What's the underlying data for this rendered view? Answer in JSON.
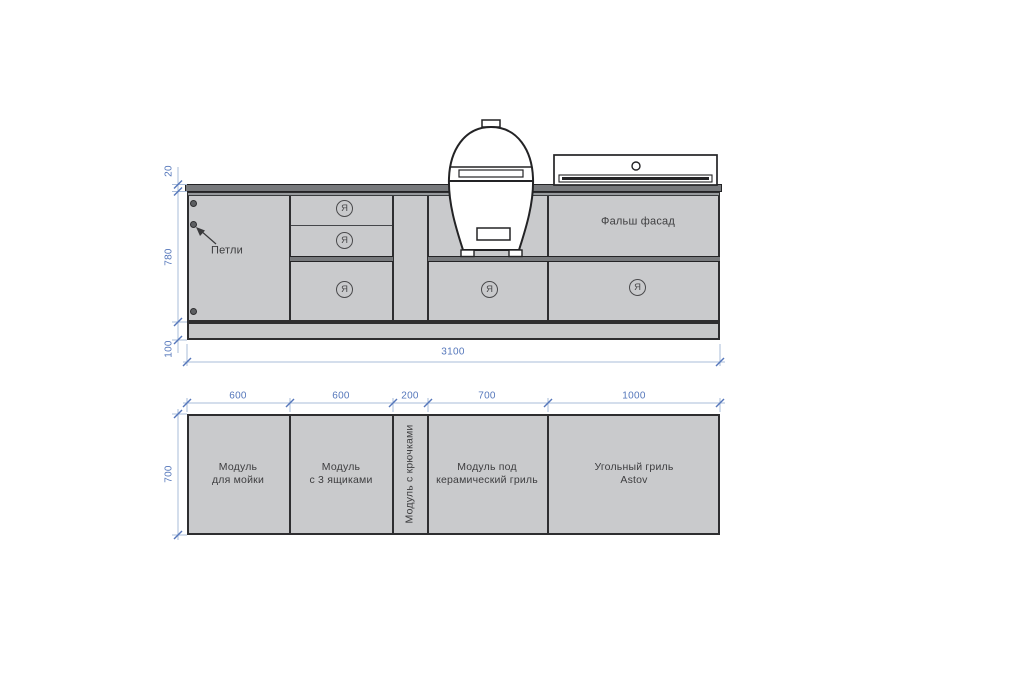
{
  "drawing": {
    "type": "outdoor-kitchen cabinetry drawing, front elevation and plan view",
    "colors": {
      "cabinet_fill": "#c9cacc",
      "countertop_fill": "#77797c",
      "plinth_fill": "#c6c7c9",
      "outline": "#2e2e30",
      "dimension_line": "#aabdd9",
      "dimension_text": "#5577bb",
      "label_text": "#3d3d3f"
    },
    "icons": {
      "kamado": "kamado-ceramic-grill-icon",
      "astov": "charcoal-grill-lid-icon"
    }
  },
  "elevation": {
    "hinges_label": "Петли",
    "false_front_label": "Фальш фасад",
    "drawer_mark": "Я",
    "dim_countertop": "20",
    "dim_height": "780",
    "dim_plinth": "100",
    "dim_width": "3100"
  },
  "plan": {
    "dim_depth": "700",
    "modules": [
      {
        "dim": "600",
        "line1": "Модуль",
        "line2": "для мойки"
      },
      {
        "dim": "600",
        "line1": "Модуль",
        "line2": "с 3 ящиками"
      },
      {
        "dim": "200",
        "line1": "Модуль с крючками",
        "line2": ""
      },
      {
        "dim": "700",
        "line1": "Модуль под",
        "line2": "керамический гриль"
      },
      {
        "dim": "1000",
        "line1": "Угольный гриль",
        "line2": "Astov"
      }
    ]
  }
}
